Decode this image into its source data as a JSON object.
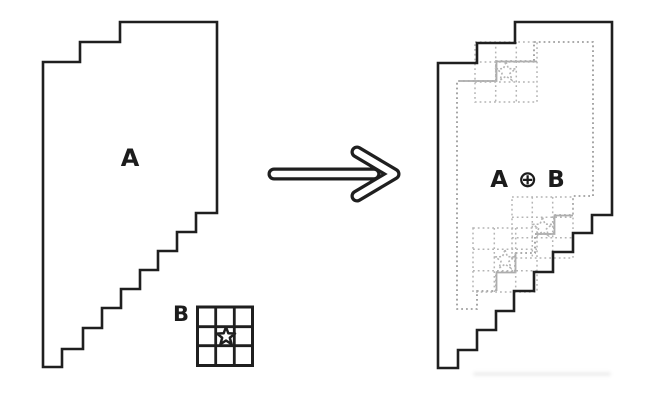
{
  "diagram": {
    "labels": {
      "shape_a": "A",
      "structuring_element": "B",
      "result": "A ⊕ B"
    },
    "structuring_element": {
      "rows": 3,
      "cols": 3,
      "origin_marker": "star"
    },
    "colors": {
      "line": "#1f1f1f",
      "dotted_outline": "#8f8f8f",
      "overlay_grid": "#b4b4b4",
      "background": "#ffffff"
    }
  }
}
